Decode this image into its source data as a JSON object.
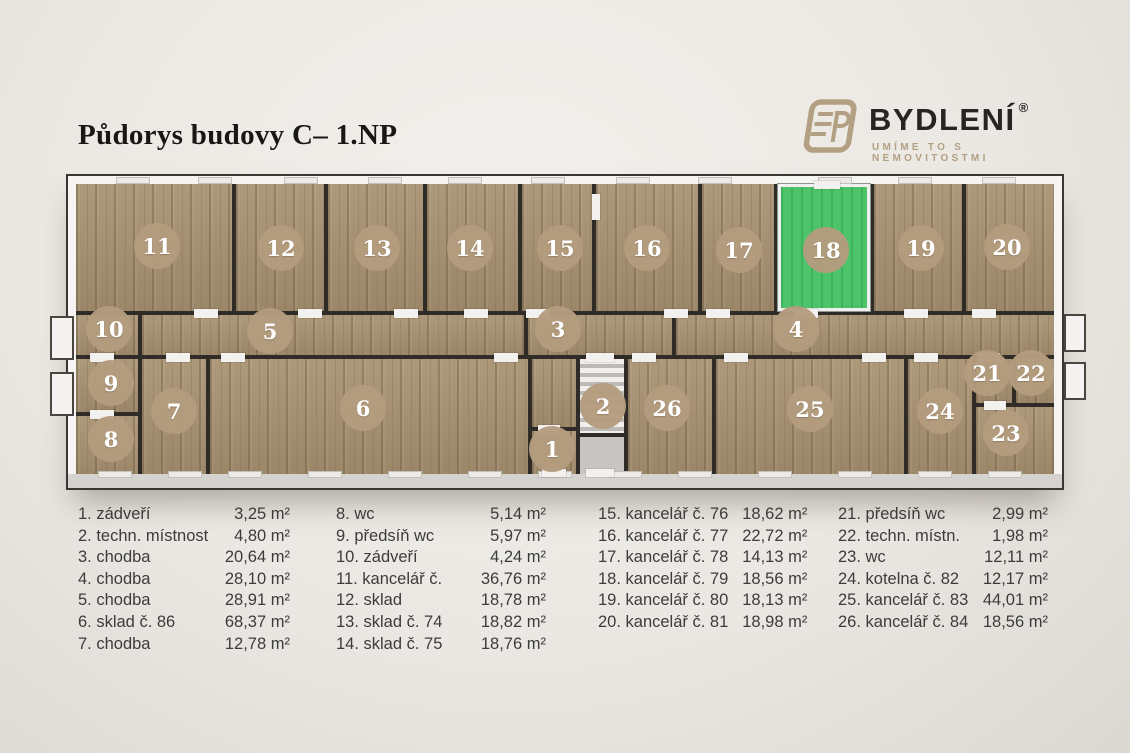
{
  "page": {
    "title": "Půdorys budovy C– 1.NP"
  },
  "logo": {
    "brand": "BYDLENÍ",
    "registered_mark": "®",
    "tagline": "UMÍME TO S NEMOVITOSTMI",
    "accent_color": "#b3a082"
  },
  "floor_plan": {
    "highlighted_room": "18",
    "highlight_color": "#4ec46a",
    "badge_color": "#b49c7e",
    "rooms": [
      {
        "number": "1"
      },
      {
        "number": "2"
      },
      {
        "number": "3"
      },
      {
        "number": "4"
      },
      {
        "number": "5"
      },
      {
        "number": "6"
      },
      {
        "number": "7"
      },
      {
        "number": "8"
      },
      {
        "number": "9"
      },
      {
        "number": "10"
      },
      {
        "number": "11"
      },
      {
        "number": "12"
      },
      {
        "number": "13"
      },
      {
        "number": "14"
      },
      {
        "number": "15"
      },
      {
        "number": "16"
      },
      {
        "number": "17"
      },
      {
        "number": "18"
      },
      {
        "number": "19"
      },
      {
        "number": "20"
      },
      {
        "number": "21"
      },
      {
        "number": "22"
      },
      {
        "number": "23"
      },
      {
        "number": "24"
      },
      {
        "number": "25"
      },
      {
        "number": "26"
      }
    ]
  },
  "legend": {
    "columns": [
      {
        "items": [
          {
            "label": "1. zádveří",
            "area": "3,25 m²"
          },
          {
            "label": "2. techn. místnost",
            "area": "4,80 m²"
          },
          {
            "label": "3. chodba",
            "area": "20,64 m²"
          },
          {
            "label": "4. chodba",
            "area": "28,10 m²"
          },
          {
            "label": "5. chodba",
            "area": "28,91 m²"
          },
          {
            "label": "6. sklad č. 86",
            "area": "68,37 m²"
          },
          {
            "label": "7. chodba",
            "area": "12,78 m²"
          }
        ]
      },
      {
        "items": [
          {
            "label": "8. wc",
            "area": "5,14 m²"
          },
          {
            "label": "9. předsíň wc",
            "area": "5,97 m²"
          },
          {
            "label": "10. zádveří",
            "area": "4,24 m²"
          },
          {
            "label": "11. kancelář č.",
            "area": "36,76 m²"
          },
          {
            "label": "12. sklad",
            "area": "18,78 m²"
          },
          {
            "label": "13. sklad č. 74",
            "area": "18,82 m²"
          },
          {
            "label": "14. sklad č. 75",
            "area": "18,76 m²"
          }
        ]
      },
      {
        "items": [
          {
            "label": "15. kancelář č. 76",
            "area": "18,62 m²"
          },
          {
            "label": "16. kancelář č. 77",
            "area": "22,72 m²"
          },
          {
            "label": "17. kancelář č. 78",
            "area": "14,13 m²"
          },
          {
            "label": "18. kancelář č. 79",
            "area": "18,56 m²"
          },
          {
            "label": "19. kancelář č. 80",
            "area": "18,13 m²"
          },
          {
            "label": "20. kancelář č. 81",
            "area": "18,98 m²"
          }
        ]
      },
      {
        "items": [
          {
            "label": "21. předsíň wc",
            "area": "2,99 m²"
          },
          {
            "label": "22. techn. místn.",
            "area": "1,98 m²"
          },
          {
            "label": "23. wc",
            "area": "12,11 m²"
          },
          {
            "label": "24. kotelna č. 82",
            "area": "12,17 m²"
          },
          {
            "label": "25. kancelář č. 83",
            "area": "44,01 m²"
          },
          {
            "label": "26. kancelář č. 84",
            "area": "18,56 m²"
          }
        ]
      }
    ]
  }
}
